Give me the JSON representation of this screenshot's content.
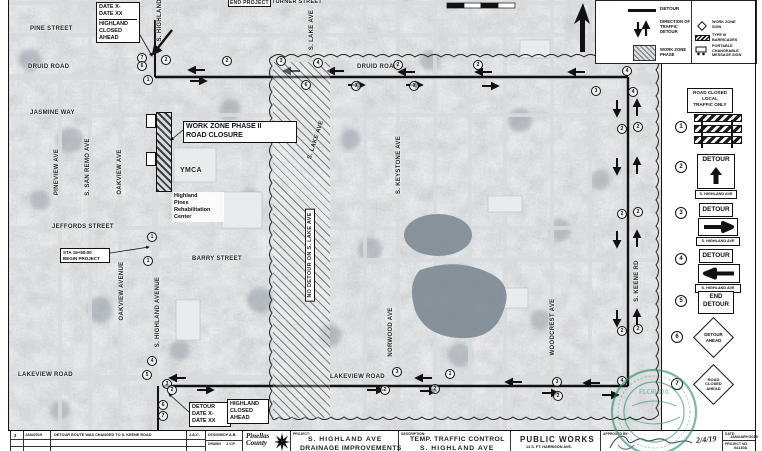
{
  "map": {
    "labels": {
      "pine": "PINE STREET",
      "druid_w": "DRUID ROAD",
      "druid_c": "DRUID ROAD",
      "jasmine": "JASMINE WAY",
      "turner": "TURNER STREET",
      "end_project": "END PROJECT",
      "pineview": "PINEVIEW AVE",
      "sanremo": "S. SAN REMO AVE",
      "oakview_n": "OAKVIEW AVE",
      "oakview_s": "OAKVIEW AVENUE",
      "jeffords": "JEFFORDS STREET",
      "barry": "BARRY STREET",
      "lakeview_w": "LAKEVIEW ROAD",
      "lakeview_c": "LAKEVIEW ROAD",
      "highland_top": "S. HIGHLAND AVE",
      "highland_s": "S. HIGHLAND AVENUE",
      "lake_top": "S. LAKE AVE",
      "lake_mid": "S. LAKE AVE",
      "keystone": "S. KEYSTONE AVE",
      "norwood": "NORWOOD AVE",
      "woodcrest": "WOODCREST AVE",
      "keene": "S. KEENE RD",
      "ymca": "YMCA",
      "no_detour": "NO DETOUR ON S. LAKE AVE"
    },
    "callouts": {
      "msg_top": [
        "DATE X-",
        "DATE XX",
        "HIGHLAND",
        "CLOSED",
        "AHEAD"
      ],
      "workzone": [
        "WORK ZONE PHASE II",
        "ROAD CLOSURE"
      ],
      "rehab": [
        "Highland",
        "Pines",
        "Rehabilitation",
        "Center"
      ],
      "sta_begin": [
        "STA 15+50.00",
        "BEGIN PROJECT"
      ],
      "msg_bottom_detour": [
        "DETOUR",
        "DATE X-",
        "DATE XX"
      ],
      "msg_bottom_highland": [
        "HIGHLAND",
        "CLOSED",
        "AHEAD"
      ]
    },
    "markers": [
      "7",
      "6",
      "1",
      "2",
      "2",
      "3",
      "4",
      "2",
      "2",
      "4",
      "3",
      "3",
      "6",
      "3",
      "4",
      "2",
      "2",
      "2",
      "2",
      "2",
      "2",
      "3",
      "1",
      "2",
      "2",
      "3",
      "2",
      "4",
      "4",
      "5",
      "3",
      "2",
      "6",
      "7",
      "1",
      "1"
    ]
  },
  "legend": {
    "detour": "DETOUR",
    "direction": [
      "DIRECTION OF",
      "TRAFFIC",
      "DETOUR"
    ],
    "work_zone_phase": [
      "WORK ZONE",
      "PHASE"
    ],
    "work_zone_sign": [
      "WORK ZONE",
      "SIGN"
    ],
    "type_iii": [
      "TYPE III",
      "BARRICADES"
    ],
    "pcms": [
      "PORTABLE",
      "CHANGEABLE",
      "MESSAGE SIGN"
    ]
  },
  "sidebar": {
    "road_closed": [
      "ROAD CLOSED",
      "LOCAL",
      "TRAFFIC ONLY"
    ],
    "nums": [
      "1",
      "2",
      "3",
      "4",
      "5",
      "6",
      "7"
    ],
    "detour": "DETOUR",
    "plaque": "S. HIGHLAND AVE",
    "end_detour": [
      "END",
      "DETOUR"
    ],
    "detour_ahead": [
      "DETOUR",
      "AHEAD"
    ],
    "road_closed_ahead": [
      "ROAD",
      "CLOSED",
      "AHEAD"
    ]
  },
  "titleblock": {
    "rev_no": "3",
    "rev_date": "JAN/2019",
    "rev_desc": "DETOUR ROUTE WAS CHANGED TO S. KEENE ROAD",
    "rev_by": "J.A.C.",
    "designed_label": "DESIGNED",
    "designed": "F.A.B.",
    "drawn_label": "DRAWN",
    "drawn": "J.V.P.",
    "logo1": "Pinellas",
    "logo2": "County",
    "project_label": "PROJECT:",
    "project1": "S. HIGHLAND AVE",
    "project2": "DRAINAGE IMPROVEMENTS",
    "desc_label": "DESCRIPTION:",
    "desc1": "TEMP. TRAFFIC CONTROL",
    "desc2": "S. HIGHLAND AVE",
    "dept1": "PUBLIC WORKS",
    "dept2": "14 S. FT. HARRISON AVE.",
    "approved_label": "APPROVED BY:",
    "approved_date": "2/4/19",
    "date_label": "DATE:",
    "date": "JANUARY/2019",
    "projno_label": "PROJECT NO.",
    "projno": "04130A"
  },
  "stamp": {
    "state": "FLORIDA",
    "date_note": "2/4/19"
  }
}
